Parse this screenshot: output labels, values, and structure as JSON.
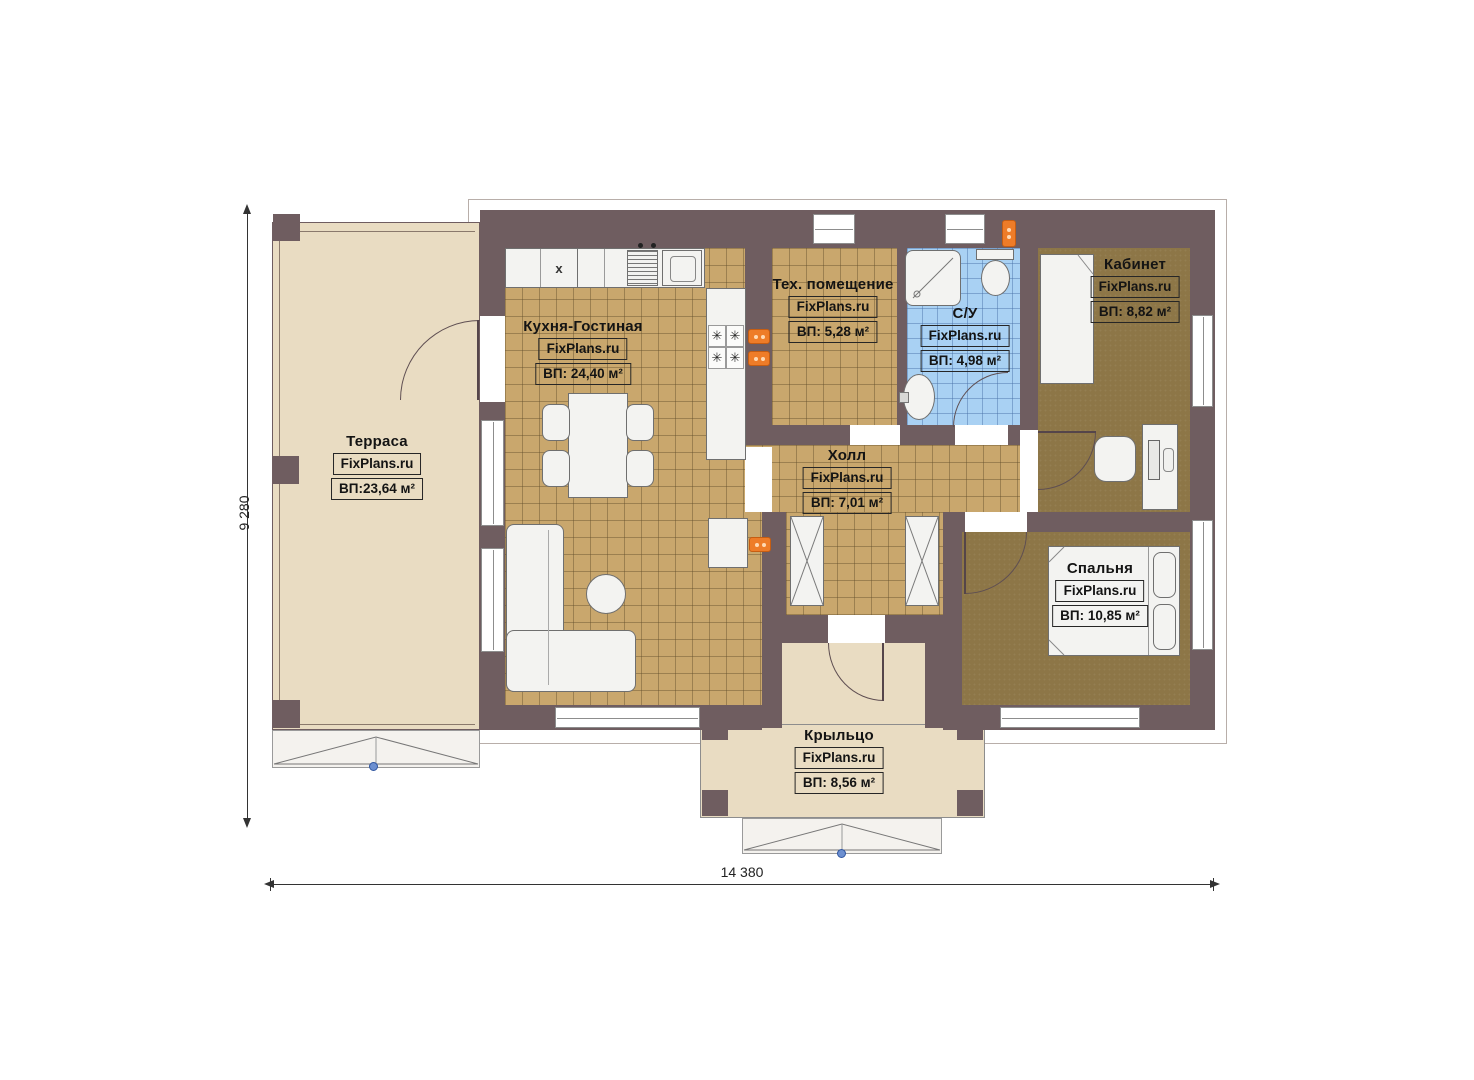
{
  "plan_title": "Floor plan (single storey house)",
  "watermark": "FixPlans.ru",
  "dimensions": {
    "left_vertical": "9 280",
    "bottom_horizontal": "14 380"
  },
  "rooms": [
    {
      "id": "terrace",
      "name": "Терраса",
      "watermark": "FixPlans.ru",
      "area": "ВП:23,64 м²"
    },
    {
      "id": "kitchen-living",
      "name": "Кухня-Гостиная",
      "watermark": "FixPlans.ru",
      "area": "ВП: 24,40 м²"
    },
    {
      "id": "tech-room",
      "name": "Тех. помещение",
      "watermark": "FixPlans.ru",
      "area": "ВП: 5,28 м²"
    },
    {
      "id": "bathroom",
      "name": "С/У",
      "watermark": "FixPlans.ru",
      "area": "ВП: 4,98 м²"
    },
    {
      "id": "office",
      "name": "Кабинет",
      "watermark": "FixPlans.ru",
      "area": "ВП: 8,82 м²"
    },
    {
      "id": "hall",
      "name": "Холл",
      "watermark": "FixPlans.ru",
      "area": "ВП: 7,01 м²"
    },
    {
      "id": "bedroom",
      "name": "Спальня",
      "watermark": "FixPlans.ru",
      "area": "ВП: 10,85 м²"
    },
    {
      "id": "porch",
      "name": "Крыльцо",
      "watermark": "FixPlans.ru",
      "area": "ВП: 8,56 м²"
    }
  ],
  "glyphs": {
    "stove_burner": "✳",
    "kitchen_cabinet_marker": "x"
  },
  "colors": {
    "wall": "#6f5d60",
    "tile_tan": "#c9a76d",
    "tile_blue": "#a9d1f3",
    "carpet_brown": "#8d7647",
    "terrace_beige": "#e9dcc2",
    "radiator_orange": "#ee7c28",
    "handle_blue": "#6c8fd0"
  }
}
